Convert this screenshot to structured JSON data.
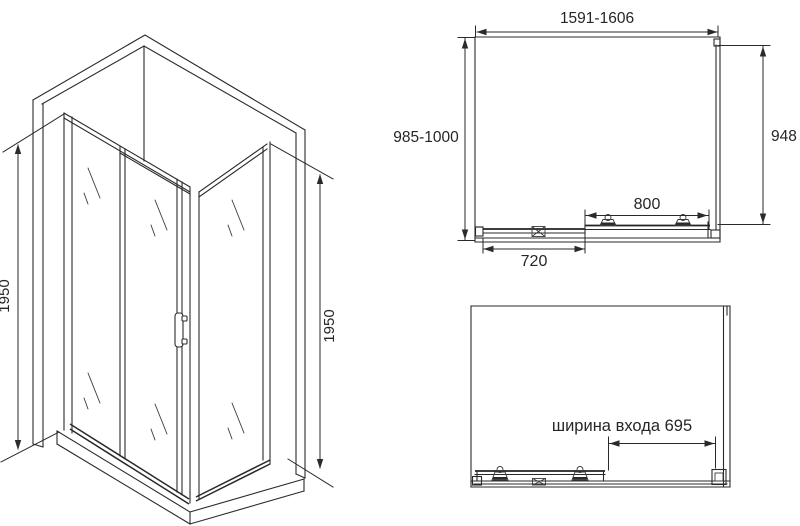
{
  "diagram": {
    "title": "shower-enclosure-dimension-drawing",
    "colors": {
      "line": "#2a2a2a",
      "background": "#ffffff",
      "text": "#262626"
    },
    "iso_view": {
      "height_left_label": "1950",
      "height_right_label": "1950"
    },
    "plan_view": {
      "width_range_label": "1591-1606",
      "depth_range_label": "985-1000",
      "side_panel_label": "948",
      "door_width_label": "800",
      "fixed_panel_label": "720"
    },
    "open_view": {
      "entrance_width_label": "ширина входа 695"
    }
  }
}
